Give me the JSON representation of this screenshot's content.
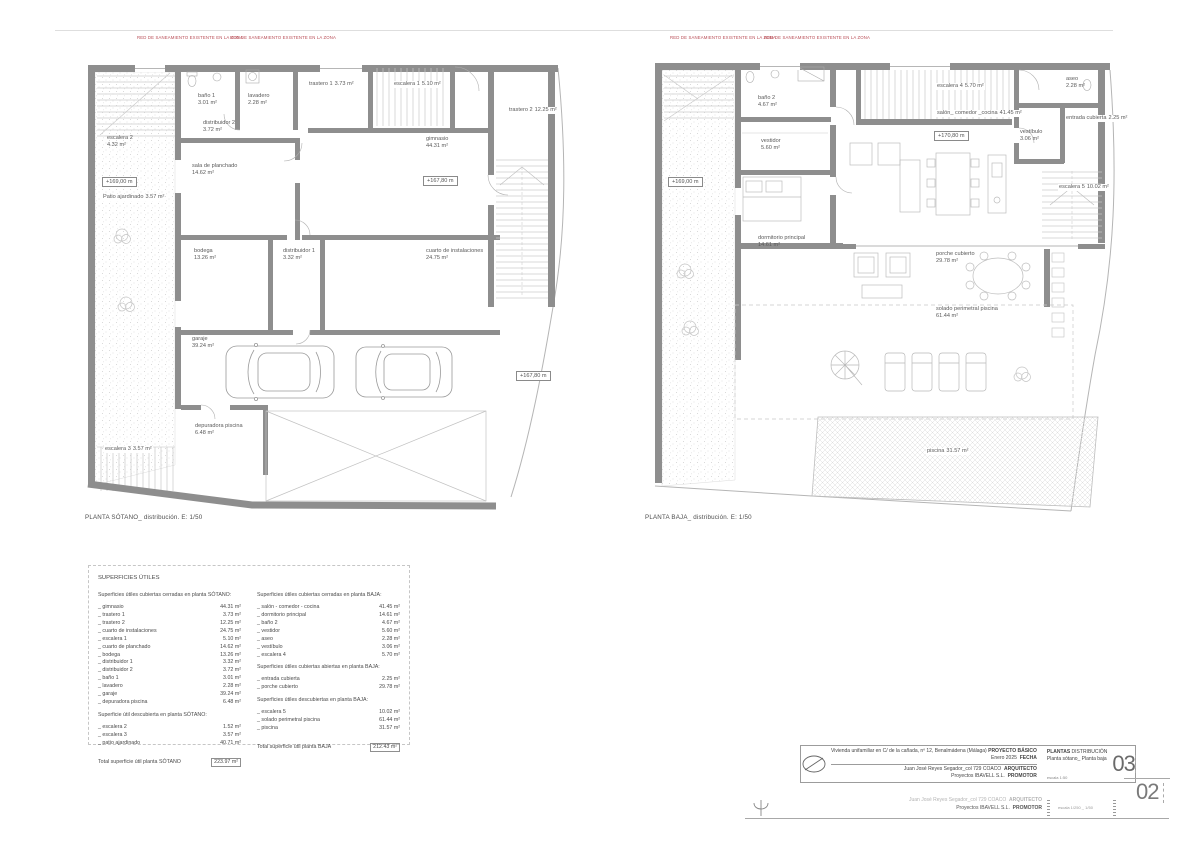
{
  "sheet": {
    "red_note": "RED DE SANEAMIENTO EXISTENTE EN LA ZONA"
  },
  "plans": {
    "sotano": {
      "caption": "PLANTA SÓTANO_ distribución. E: 1/50",
      "levels": [
        "+169,00 m",
        "+167,80 m",
        "+167,80 m"
      ],
      "rooms": [
        {
          "n": "escalera 2",
          "a": "4.32 m²"
        },
        {
          "n": "baño 1",
          "a": "3.01 m²"
        },
        {
          "n": "lavadero",
          "a": "2.28 m²"
        },
        {
          "n": "trastero 1",
          "a": "3.73 m²"
        },
        {
          "n": "escalera 1",
          "a": "5.10 m²"
        },
        {
          "n": "trastero 2",
          "a": "12.25 m²"
        },
        {
          "n": "distribuidor 2",
          "a": "3.72 m²"
        },
        {
          "n": "gimnasio",
          "a": "44.31 m²"
        },
        {
          "n": "sala de planchado",
          "a": "14.62 m²"
        },
        {
          "n": "Patio ajardinado",
          "a": "3.57 m²"
        },
        {
          "n": "bodega",
          "a": "13.26 m²"
        },
        {
          "n": "distribuidor 1",
          "a": "3.32 m²"
        },
        {
          "n": "cuarto de instalaciones",
          "a": "24.75 m²"
        },
        {
          "n": "garaje",
          "a": "39.24 m²"
        },
        {
          "n": "depuradora piscina",
          "a": "6.48 m²"
        },
        {
          "n": "escalera 3",
          "a": "3.57 m²"
        }
      ]
    },
    "baja": {
      "caption": "PLANTA BAJA_ distribución. E: 1/50",
      "levels": [
        "+169,00 m",
        "+170,80 m"
      ],
      "rooms": [
        {
          "n": "baño 2",
          "a": "4.67 m²"
        },
        {
          "n": "escalera 4",
          "a": "5.70 m²"
        },
        {
          "n": "aseo",
          "a": "2.28 m²"
        },
        {
          "n": "vestíbulo",
          "a": "3.06 m²"
        },
        {
          "n": "salón_ comedor _cocina",
          "a": "41.45 m²"
        },
        {
          "n": "entrada cubierta",
          "a": "2.25 m²"
        },
        {
          "n": "vestidor",
          "a": "5.60 m²"
        },
        {
          "n": "escalera 5",
          "a": "10.02 m²"
        },
        {
          "n": "dormitorio principal",
          "a": "14.61 m²"
        },
        {
          "n": "porche cubierto",
          "a": "29.78 m²"
        },
        {
          "n": "solado perimetral piscina",
          "a": "61.44 m²"
        },
        {
          "n": "piscina",
          "a": "31.57 m²"
        }
      ]
    }
  },
  "surfaces": {
    "title": "SUPERFICIES ÚTILES",
    "sotano_closed_header": "Superficies útiles cubiertas cerradas en planta SÓTANO:",
    "sotano_closed": [
      {
        "n": "_ gimnasio",
        "v": "44.31 m²"
      },
      {
        "n": "_ trastero 1",
        "v": "3.73 m²"
      },
      {
        "n": "_ trastero 2",
        "v": "12.25 m²"
      },
      {
        "n": "_ cuarto de instalaciones",
        "v": "24.75 m²"
      },
      {
        "n": "_ escalera 1",
        "v": "5.10 m²"
      },
      {
        "n": "_ cuarto de planchado",
        "v": "14.62 m²"
      },
      {
        "n": "_ bodega",
        "v": "13.26 m²"
      },
      {
        "n": "_ distribuidor 1",
        "v": "3.32 m²"
      },
      {
        "n": "_ distribuidor 2",
        "v": "3.72 m²"
      },
      {
        "n": "_ baño 1",
        "v": "3.01 m²"
      },
      {
        "n": "_ lavadero",
        "v": "2.28 m²"
      },
      {
        "n": "_ garaje",
        "v": "39.24 m²"
      },
      {
        "n": "_ depuradora piscina",
        "v": "6.48 m²"
      }
    ],
    "sotano_open_header": "Superficie útil descubierta en planta SÓTANO:",
    "sotano_open": [
      {
        "n": "_ escalera 2",
        "v": "1.52 m²"
      },
      {
        "n": "_ escalera 3",
        "v": "3.57 m²"
      },
      {
        "n": "_ patio ajardinado",
        "v": "40.71 m²"
      }
    ],
    "sotano_total_label": "Total superficie útil planta SÓTANO",
    "sotano_total_value": "223.97 m²",
    "baja_closed_header": "Superficies útiles cubiertas cerradas en planta BAJA:",
    "baja_closed": [
      {
        "n": "_ salón - comedor - cocina",
        "v": "41.45 m²"
      },
      {
        "n": "_ dormitorio principal",
        "v": "14.61 m²"
      },
      {
        "n": "_ baño 2",
        "v": "4.67 m²"
      },
      {
        "n": "_ vestidor",
        "v": "5.60 m²"
      },
      {
        "n": "_ aseo",
        "v": "2.28 m²"
      },
      {
        "n": "_ vestíbulo",
        "v": "3.06 m²"
      },
      {
        "n": "_ escalera 4",
        "v": "5.70 m²"
      }
    ],
    "baja_covered_header": "Superficies útiles cubiertas abiertas en planta BAJA:",
    "baja_covered": [
      {
        "n": "_ entrada cubierta",
        "v": "2.25 m²"
      },
      {
        "n": "_ porche cubierto",
        "v": "29.78 m²"
      }
    ],
    "baja_open_header": "Superficies útiles descubiertas en planta BAJA:",
    "baja_open": [
      {
        "n": "_ escalera 5",
        "v": "10.02 m²"
      },
      {
        "n": "_ solado perimetral piscina",
        "v": "61.44 m²"
      },
      {
        "n": "_ piscina",
        "v": "31.57 m²"
      }
    ],
    "baja_total_label": "Total superficie útil planta BAJA",
    "baja_total_value": "212.43 m²"
  },
  "title_block": {
    "project": "Vivienda unifamiliar en C/ de la cañada, nº 12, Benalmádena (Málaga)",
    "project_label": "PROYECTO BÁSICO",
    "date": "Enero 2025",
    "date_label": "FECHA",
    "architect": "Juan José Reyes Segador_col 729 COACO",
    "architect_label": "ARQUITECTO",
    "promoter": "Proyectos IBAVELL S.L.",
    "promoter_label": "PROMOTOR",
    "sheet_title_bold": "PLANTAS",
    "sheet_title_rest": " DISTRIBUCIÓN",
    "sheet_subtitle": "Planta sótano_ Planta baja",
    "scale": "escala 1:50",
    "number": "03"
  },
  "title_block_under": {
    "architect": "Juan José Reyes Segador_col 729 COACO",
    "architect_label": "ARQUITECTO",
    "promoter": "Proyectos IBAVELL S.L.",
    "promoter_label": "PROMOTOR",
    "scale": "escala 1/250 _ 1/50",
    "number": "02"
  }
}
